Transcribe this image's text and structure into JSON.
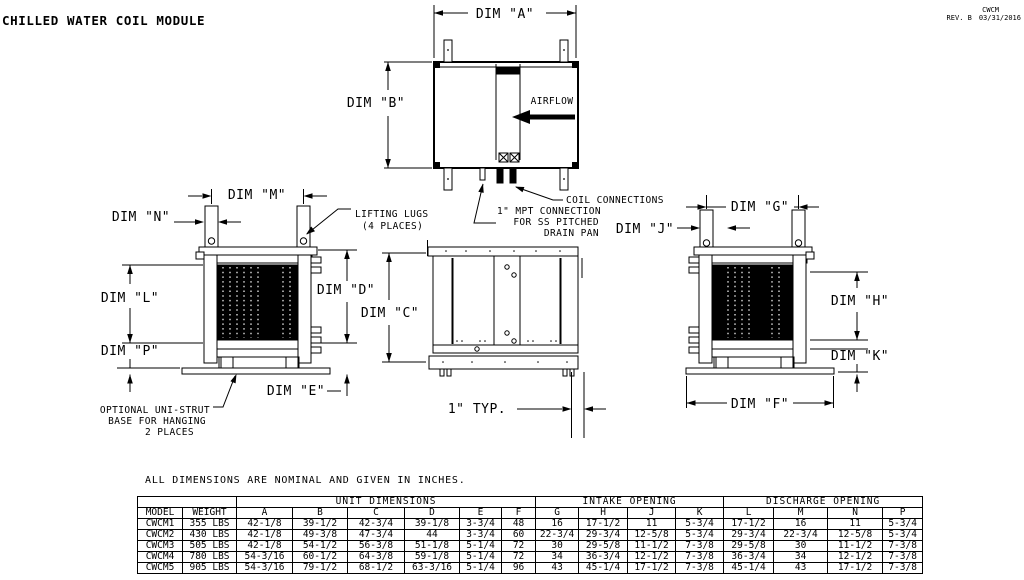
{
  "labels": {
    "title": "CHILLED WATER COIL MODULE",
    "code": "CWCM",
    "rev": "REV. B",
    "date": "03/31/2016",
    "dims": {
      "a": "DIM \"A\"",
      "b": "DIM \"B\"",
      "c": "DIM \"C\"",
      "d": "DIM \"D\"",
      "e": "DIM \"E\"",
      "f": "DIM \"F\"",
      "g": "DIM \"G\"",
      "h": "DIM \"H\"",
      "j": "DIM \"J\"",
      "k": "DIM \"K\"",
      "l": "DIM \"L\"",
      "m": "DIM \"M\"",
      "n": "DIM \"N\"",
      "p": "DIM \"P\""
    },
    "airflow": "AIRFLOW",
    "typ": "1\" TYP.",
    "coil_connections": "COIL CONNECTIONS",
    "mpt": [
      "1\" MPT CONNECTION",
      "FOR SS PITCHED",
      "DRAIN PAN"
    ],
    "lifting": [
      "LIFTING LUGS",
      "(4 PLACES)"
    ],
    "unistrut": [
      "OPTIONAL UNI-STRUT",
      "BASE FOR HANGING",
      "2 PLACES"
    ]
  },
  "table": {
    "note": "ALL DIMENSIONS ARE NOMINAL AND GIVEN IN INCHES.",
    "groups": [
      "UNIT DIMENSIONS",
      "INTAKE OPENING",
      "DISCHARGE OPENING"
    ],
    "columns": [
      "MODEL",
      "WEIGHT",
      "A",
      "B",
      "C",
      "D",
      "E",
      "F",
      "G",
      "H",
      "J",
      "K",
      "L",
      "M",
      "N",
      "P"
    ],
    "rows": [
      [
        "CWCM1",
        "355 LBS",
        "42-1/8",
        "39-1/2",
        "42-3/4",
        "39-1/8",
        "3-3/4",
        "48",
        "16",
        "17-1/2",
        "11",
        "5-3/4",
        "17-1/2",
        "16",
        "11",
        "5-3/4"
      ],
      [
        "CWCM2",
        "430 LBS",
        "42-1/8",
        "49-3/8",
        "47-3/4",
        "44",
        "3-3/4",
        "60",
        "22-3/4",
        "29-3/4",
        "12-5/8",
        "5-3/4",
        "29-3/4",
        "22-3/4",
        "12-5/8",
        "5-3/4"
      ],
      [
        "CWCM3",
        "505 LBS",
        "42-1/8",
        "54-1/2",
        "56-3/8",
        "51-1/8",
        "5-1/4",
        "72",
        "30",
        "29-5/8",
        "11-1/2",
        "7-3/8",
        "29-5/8",
        "30",
        "11-1/2",
        "7-3/8"
      ],
      [
        "CWCM4",
        "780 LBS",
        "54-3/16",
        "60-1/2",
        "64-3/8",
        "59-1/8",
        "5-1/4",
        "72",
        "34",
        "36-3/4",
        "12-1/2",
        "7-3/8",
        "36-3/4",
        "34",
        "12-1/2",
        "7-3/8"
      ],
      [
        "CWCM5",
        "905 LBS",
        "54-3/16",
        "79-1/2",
        "68-1/2",
        "63-3/16",
        "5-1/4",
        "96",
        "43",
        "45-1/4",
        "17-1/2",
        "7-3/8",
        "45-1/4",
        "43",
        "17-1/2",
        "7-3/8"
      ]
    ]
  }
}
